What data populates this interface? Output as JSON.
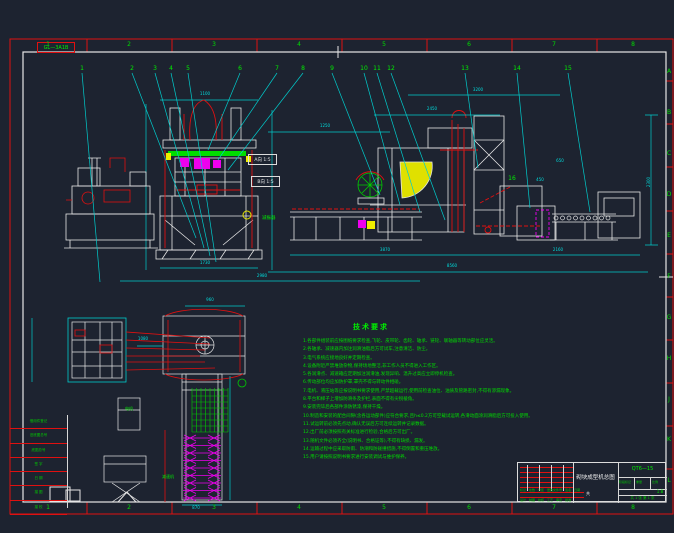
{
  "sheet": {
    "corner_label": "GL—3A1B",
    "zone_numbers_top": [
      "1",
      "2",
      "3",
      "4",
      "5",
      "6",
      "7",
      "8"
    ],
    "zone_numbers_bottom": [
      "1",
      "2",
      "3",
      "4",
      "5",
      "6",
      "7",
      "8"
    ],
    "zone_letters_right": [
      "A",
      "B",
      "C",
      "D",
      "E",
      "F",
      "G",
      "H",
      "J",
      "K",
      "L"
    ]
  },
  "balloons": [
    "1",
    "2",
    "3",
    "4",
    "5",
    "6",
    "7",
    "8",
    "9",
    "10",
    "11",
    "12",
    "13",
    "14",
    "15",
    "16"
  ],
  "view_labels": [
    {
      "text": "A向 1:5"
    },
    {
      "text": "B向 1:5"
    }
  ],
  "symbol_label": "减振器",
  "plan_labels": [
    "电机",
    "减速机"
  ],
  "dims": {
    "values": [
      "1100",
      "1730",
      "2980",
      "2450",
      "1250",
      "3870",
      "2160",
      "8560",
      "2300",
      "3200",
      "960",
      "870",
      "650",
      "450",
      "1080"
    ]
  },
  "notes": {
    "title": "技术要求",
    "lines": [
      "1.各部件组装前应按图纸要求检查,飞轮、皮带轮、齿轮、轴承、链轮、联轴器等转动部位应灵活。",
      "2.各轴承、减速器内加注润滑油脂后方可试车,注意清洁、防尘。",
      "3.电气系统应接地良好并定期检查。",
      "4.设备附近严禁堆放杂物,保持场地整洁,非工作人员不得进入工作区。",
      "5.各润滑点、减速箱应定期加注润滑油,发现异响、温升过高应立即停机检查。",
      "6.传动部位均应加防护罩,罩壳不得与转动件相碰。",
      "7.电机、液压站等应按说明书要求使用,严禁超载运行,使用前检查油位、油质及管路密封,不得有渗漏现象。",
      "8.平台和梯子上增加防滑条及护栏,表面不得有尖锐棱角。",
      "9.安装完毕后各部件涂防锈漆,保持干燥。",
      "10.制造和安装的配合间隙(含各运动部件)应符合要求,且h≤0.2方可空载试运转,各滑动面涂润滑脂后方可投入使用。",
      "11.试运转前必须先点动,确认无误后方可连续运转并记录数据。",
      "12.出厂前必须按照有关标准进行检验,合格后方可出厂。",
      "13.随机文件必须齐全(说明书、合格证等),不得有缺损、漏发。",
      "14.运输过程中应采取防雨、防潮和防碰撞措施,不得倒置和重压堆放。",
      "15.用户请按照说明书要求进行安装调试与维护保养。"
    ]
  },
  "title_block": {
    "drawing_title": "砌块成型机总图",
    "model": "QT6—15",
    "stage_label": "阶段标记",
    "weight_label": "重量",
    "scale_label": "比例",
    "scale": "1:8",
    "sheet_note": "共 1 张 第 1 张",
    "glyph": "共",
    "sig_labels": [
      "设计",
      "制图",
      "校核",
      "工艺",
      "审定",
      "批准"
    ],
    "rev_labels": [
      "标记",
      "处数",
      "分区",
      "更改文件号",
      "签名",
      "日期"
    ]
  },
  "margin_rows": [
    "借用件登记",
    "旧底图总号",
    "底图总号",
    "签 字",
    "日 期",
    "描 图",
    "描 校"
  ]
}
